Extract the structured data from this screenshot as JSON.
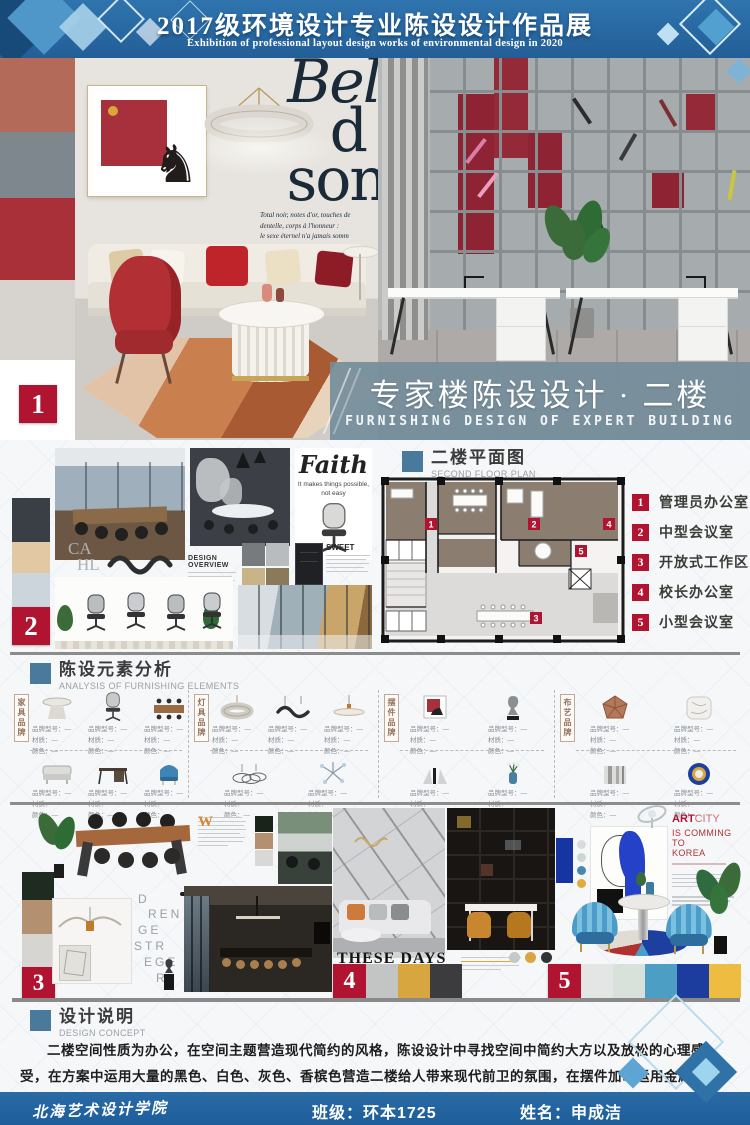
{
  "banner": {
    "title_cn": "2017级环境设计专业陈设设计作品展",
    "title_en": "Exhibition of professional layout design works of environmental design in 2020"
  },
  "hero": {
    "badge": "1",
    "swatches": [
      "#b46a58",
      "#7e868e",
      "#a93038",
      "#d7d3ce"
    ],
    "magazine": {
      "word1": "Bel",
      "word2": "d",
      "word3": "son",
      "cap1": "Total noir, notes d'or, touches de",
      "cap2": "dentelle, corps à l'honneur :",
      "cap3": "le sexe éternel n'a jamais somm"
    },
    "band": {
      "title_cn": "专家楼陈设设计 · 二楼",
      "title_en": "FURNISHING DESIGN OF EXPERT BUILDING"
    }
  },
  "section2": {
    "badge": "2",
    "swatches": [
      "#3a3e45",
      "#e2c9a4",
      "#ccd5dc"
    ],
    "dots": [
      "#cfdbe6",
      "#e6d0ac",
      "#262d35"
    ],
    "materials": [
      "#777b7e",
      "#b9bcbe",
      "#c9b489",
      "#8a7a5a"
    ],
    "faith_title": "Faith",
    "faith_sub": "It makes things possible, not easy",
    "sweet_title": "SWEET",
    "overview_title": "DESIGN OVERVIEW",
    "cahl_1": "CA",
    "cahl_2": "HL"
  },
  "floor_plan": {
    "title_cn": "二楼平面图",
    "title_en": "SECOND FLOOR PLAN",
    "legend": [
      {
        "num": "1",
        "label": "管理员办公室"
      },
      {
        "num": "2",
        "label": "中型会议室"
      },
      {
        "num": "3",
        "label": "开放式工作区"
      },
      {
        "num": "4",
        "label": "校长办公室"
      },
      {
        "num": "5",
        "label": "小型会议室"
      }
    ]
  },
  "elements": {
    "title_cn": "陈设元素分析",
    "title_en": "ANALYSIS OF FURNISHING ELEMENTS",
    "spec_label": "品牌型号：—",
    "material_label": "材质：—",
    "color_label": "颜色：—",
    "groups": [
      {
        "label": "家具品牌"
      },
      {
        "label": "灯具品牌"
      },
      {
        "label": "摆件品牌"
      },
      {
        "label": "布艺品牌"
      }
    ]
  },
  "panel3": {
    "badge": "3",
    "swatches": [
      "#1f2a21",
      "#b29070",
      "#d6d5d2"
    ],
    "minis": [
      "#18231a",
      "#b29070",
      "#d8d8d6"
    ],
    "dropcap": "W",
    "letters": [
      "D",
      "REN",
      "GE",
      "STR",
      "EGE",
      "R"
    ]
  },
  "panel4": {
    "badge": "4",
    "title": "THESE DAYS",
    "swatches": [
      "#c3c5c4",
      "#d8a63e",
      "#3c3c3e"
    ],
    "dots": [
      "#c6c8c7",
      "#d9a741",
      "#303436"
    ]
  },
  "panel5": {
    "badge": "5",
    "art_bold": "ART",
    "art_light": "CITY",
    "art_line2": "IS COMMING TO",
    "art_line3": "KOREA",
    "swatches": [
      "#e4e6e5",
      "#d8e2da",
      "#4d9ec4",
      "#1d3d9e",
      "#eebc40"
    ],
    "minidots": [
      "#d9dbdc",
      "#ccd8cf",
      "#4b86ad",
      "#e0ac3e"
    ]
  },
  "concept": {
    "title_cn": "设计说明",
    "title_en": "DESIGN CONCEPT",
    "body": "二楼空间性质为办公，在空间主题营造现代简约的风格，陈设设计中寻找空间中简约大方以及放松的心理感受，在方案中运用大量的黑色、白色、灰色、香槟色营造二楼给人带来现代前卫的氛围，在摆件加以运用金属、玻璃、陶瓷等具有高级质感的摆件点缀空间的，同时也塑造了简约时尚的空间情绪。"
  },
  "footer": {
    "school": "北海艺术设计学院",
    "class_label": "班级：环本1725",
    "name_label": "姓名：申成洁"
  },
  "palette": {
    "banner_blue": "#2b6ba5",
    "accent_red": "#b01430",
    "header_square": "#4a7a9b",
    "band_slate": "#74909f"
  }
}
